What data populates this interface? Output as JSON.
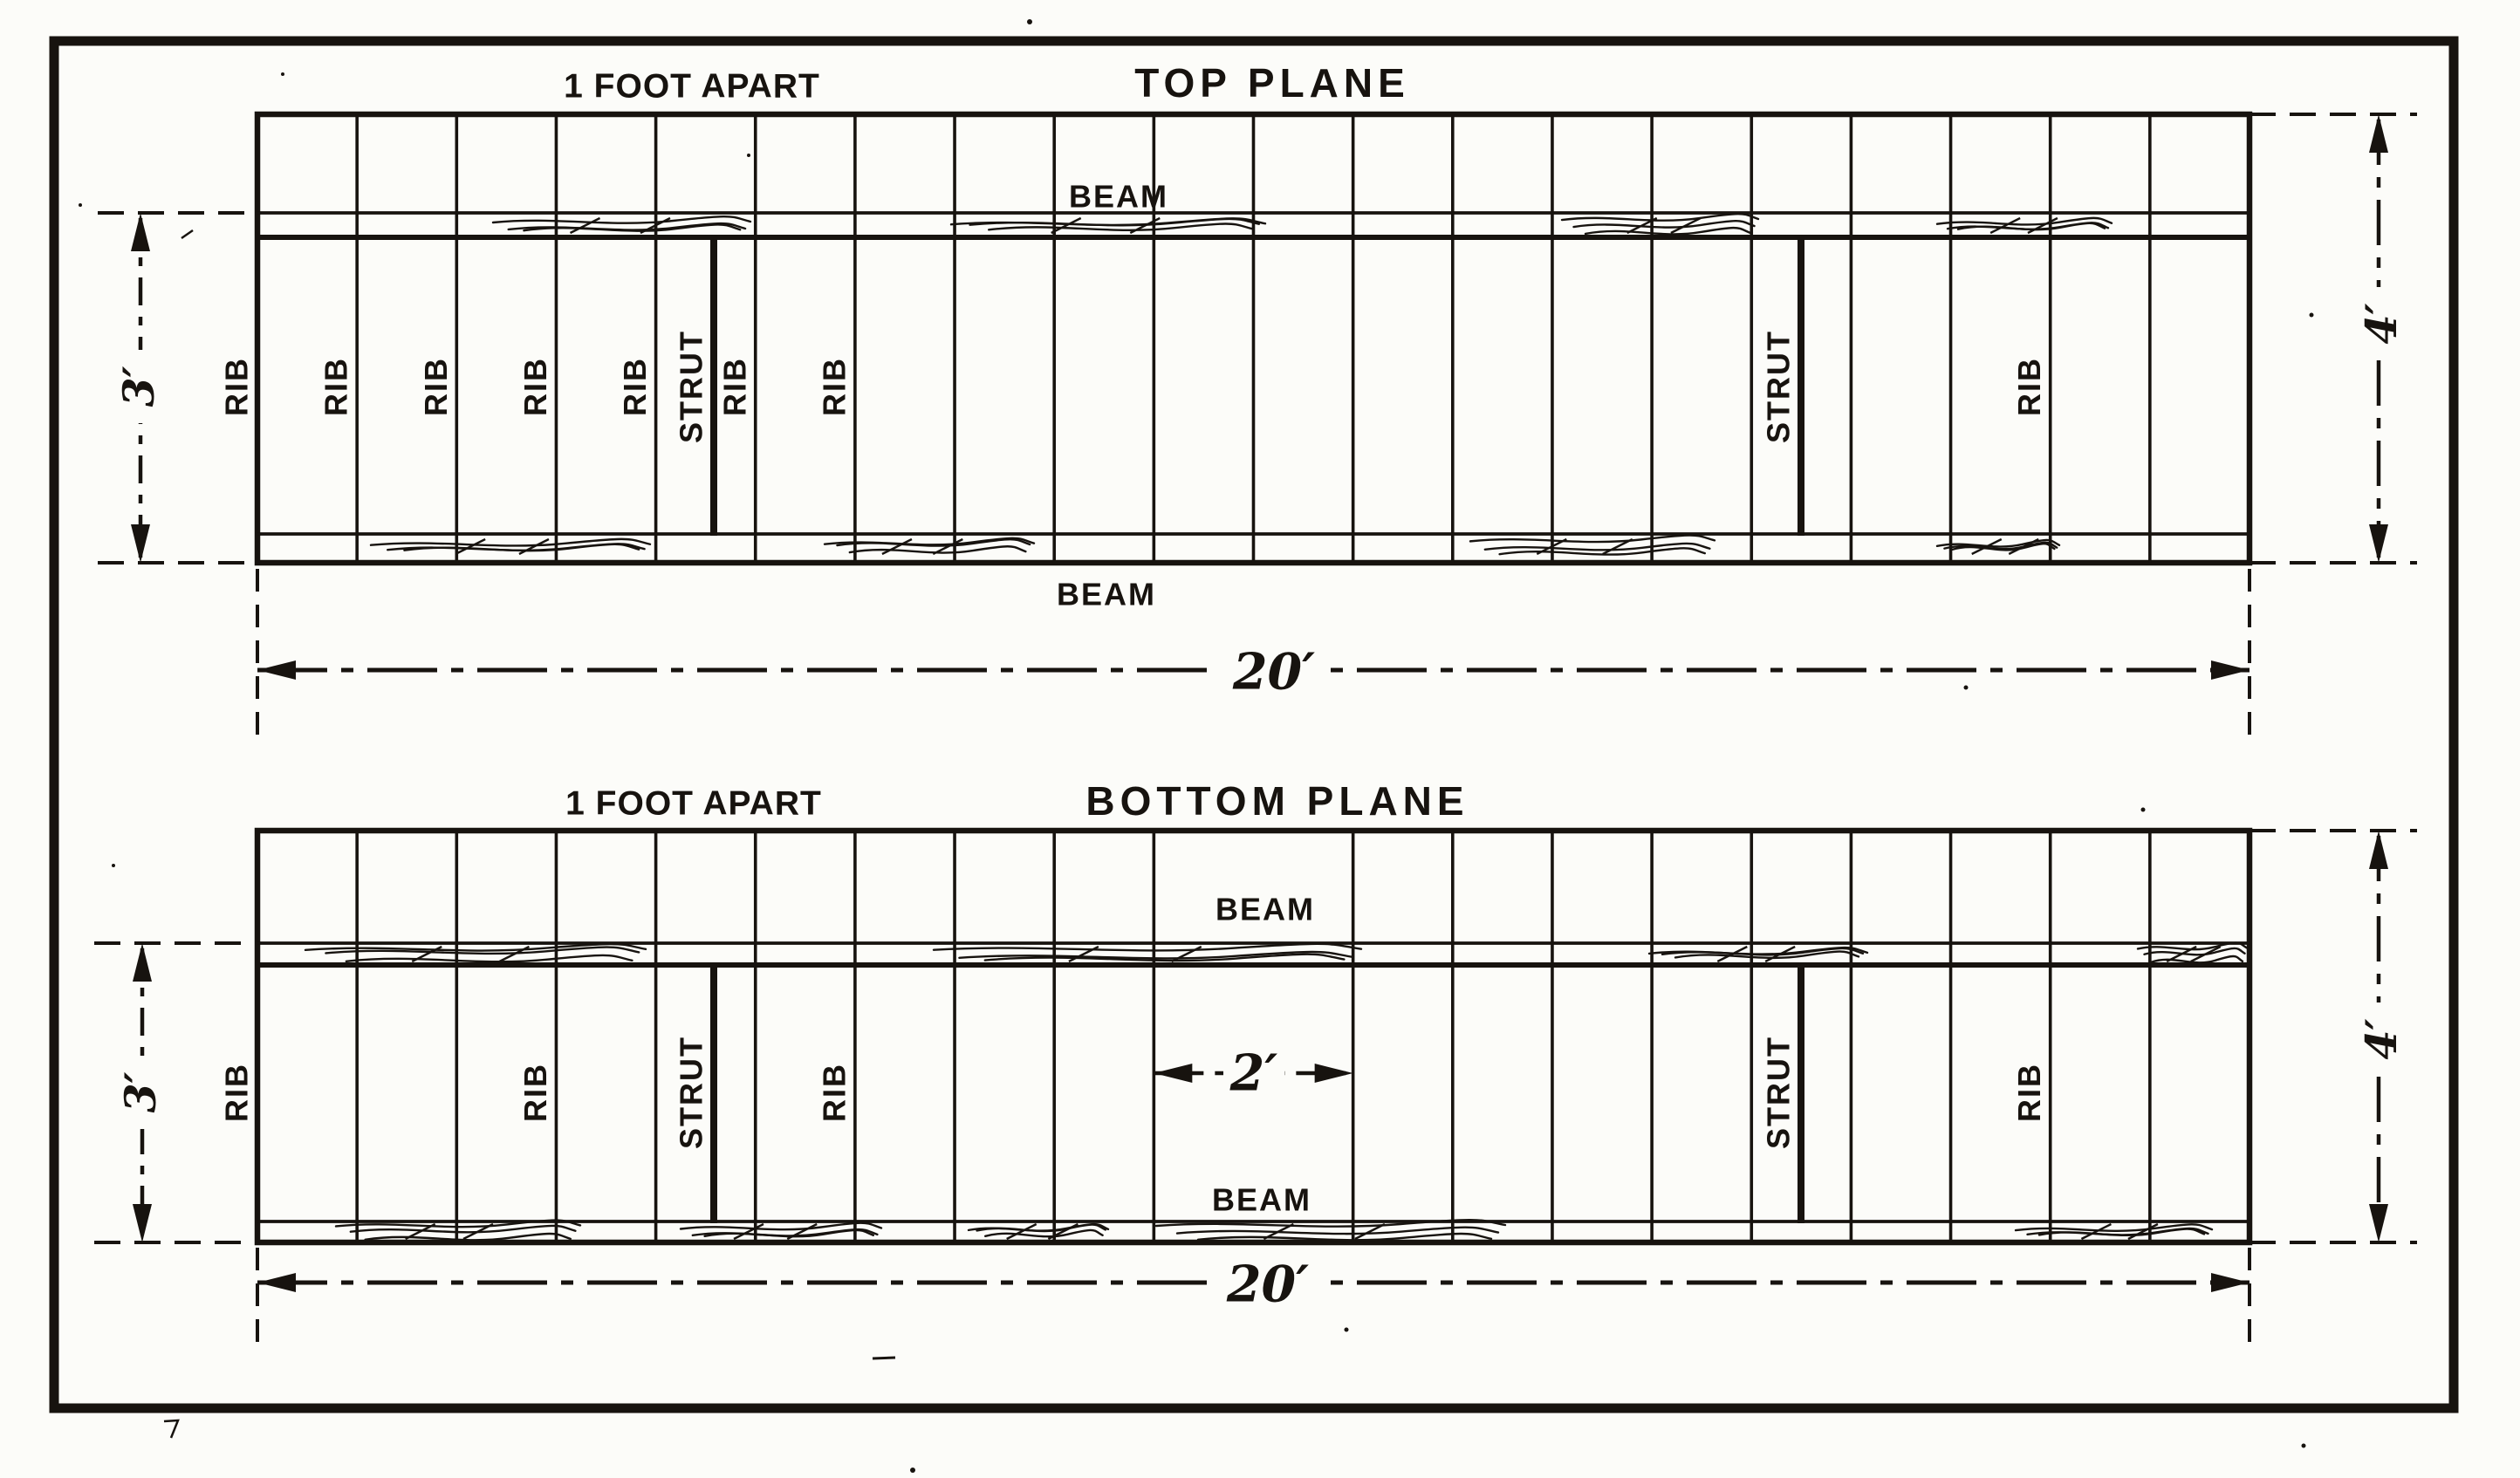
{
  "figure": {
    "kind": "biplane-wing-framing-diagram",
    "colors": {
      "ink": "#17130f",
      "paper": "#fcfcf9"
    },
    "planes": [
      {
        "title": "TOP PLANE",
        "spacing_note": "1 FOOT APART",
        "beam_label": "BEAM",
        "rib_label": "RIB",
        "strut_label": "STRUT",
        "span_dim": "20′",
        "chord_dim": "4′",
        "beam_gap_dim": "3′",
        "mid_dim": null,
        "bays": 20,
        "rib_spacing_feet": 1,
        "ribs_labeled_at": [
          0,
          1,
          2,
          3,
          4,
          5,
          6,
          18
        ],
        "strut_mid_bays": [
          5,
          16
        ],
        "omitted_ribs": []
      },
      {
        "title": "BOTTOM PLANE",
        "spacing_note": "1 FOOT APART",
        "beam_label": "BEAM",
        "rib_label": "RIB",
        "strut_label": "STRUT",
        "span_dim": "20′",
        "chord_dim": "4′",
        "beam_gap_dim": "3′",
        "mid_dim": "2′",
        "mid_dim_between": [
          9,
          11
        ],
        "bays": 20,
        "rib_spacing_feet": 1,
        "ribs_labeled_at": [
          0,
          3,
          6,
          18
        ],
        "strut_mid_bays": [
          5,
          16
        ],
        "omitted_ribs": [
          10
        ]
      }
    ]
  }
}
